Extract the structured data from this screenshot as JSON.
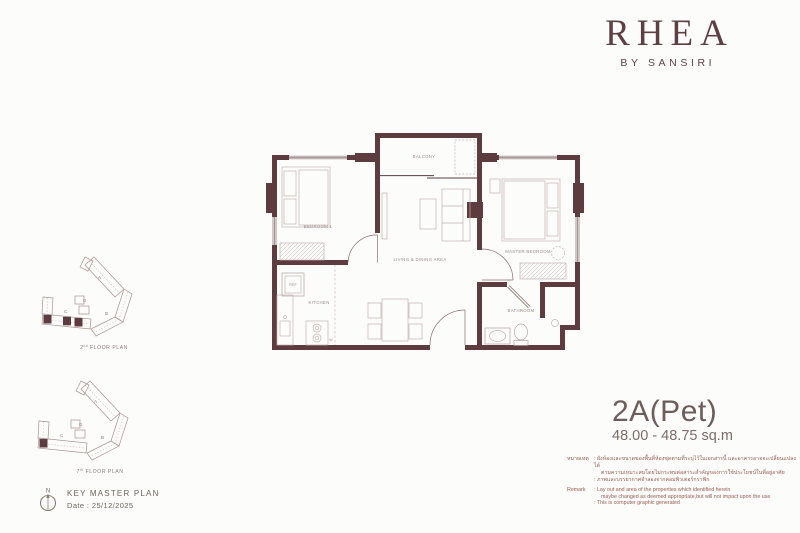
{
  "brand": {
    "name": "RHEA",
    "subtitle": "BY SANSIRI"
  },
  "unit": {
    "type": "2A(Pet)",
    "area": "48.00 - 48.75 sq.m"
  },
  "floorplan": {
    "rooms": {
      "bedroom1": "BEDROOM 1",
      "balcony": "BALCONY",
      "master_bedroom": "MASTER BEDROOM",
      "living_dining": "LIVING & DINING AREA",
      "kitchen": "KITCHEN",
      "bathroom": "BATHROOM",
      "ref": "REF",
      "washer": "W"
    }
  },
  "keyplans": {
    "wings": {
      "a": "A",
      "b": "B",
      "c": "C",
      "d": "D"
    },
    "plans": [
      {
        "ordinal": "2",
        "suffix": "nd",
        "text": "FLOOR PLAN"
      },
      {
        "ordinal": "7",
        "suffix": "th",
        "text": "FLOOR PLAN"
      }
    ]
  },
  "key_master_plan": {
    "title": "KEY MASTER PLAN",
    "date": "Date : 25/12/2025",
    "north": "N"
  },
  "remark": {
    "thai_label": "หมายเหตุ",
    "thai_lines": [
      ": ผังห้องและขนาดของพื้นที่ห้องชุดตามที่ระบุไว้ในเอกสารนี้ และอาคารอาจจะเปลี่ยนแปลงได้",
      "ตามความเหมาะสมโดยไม่กระทบต่อสาระสำคัญของการใช้ประโยชน์ในที่อยู่อาศัย",
      ": ภาพและบรรยากาศจำลองจากคอมพิวเตอร์กราฟิก"
    ],
    "english_label": "Remark",
    "english_lines": [
      ": Lay out and area of the properties which identified herein",
      "maybe changed as deemed appropriate,but will not impact upon the use",
      ": This is computer graphic generated"
    ]
  },
  "colors": {
    "wall": "#5d3b3e",
    "brand": "#5e3f43",
    "furniture_line": "#c2b2b0",
    "room_label": "#9b8c8a",
    "remark_text": "#9a5a52",
    "unit_text": "#6e5d5a",
    "background": "#fcfcfa"
  }
}
